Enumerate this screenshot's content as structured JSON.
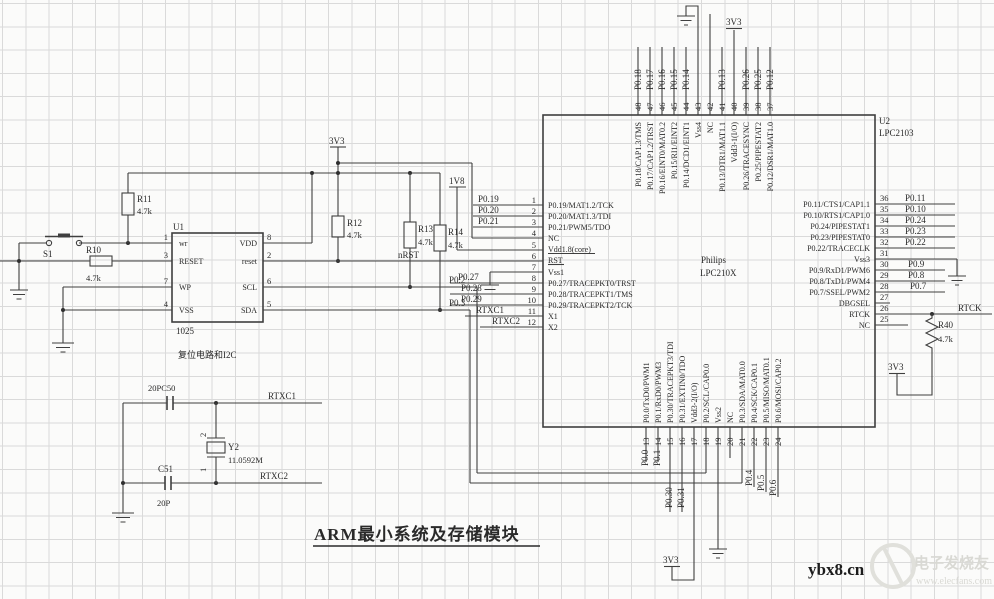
{
  "title": "ARM最小系统及存储模块",
  "watermark": {
    "site": "ybx8.cn",
    "brand": "电子发烧友",
    "url": "www.elecfans.com"
  },
  "power": {
    "v3": "3V3",
    "v18": "1V8"
  },
  "nets": {
    "nrst": "nRST",
    "p02": "P0.2",
    "p03": "P0.3",
    "rtxc1": "RTXC1",
    "rtxc2": "RTXC2",
    "rtck": "RTCK"
  },
  "u1": {
    "ref": "U1",
    "part": "1025",
    "caption": "复位电路和I2C",
    "left_pins": [
      {
        "num": "1",
        "name": "wr"
      },
      {
        "num": "3",
        "name": "RESET"
      },
      {
        "num": "7",
        "name": "WP"
      },
      {
        "num": "4",
        "name": "VSS"
      }
    ],
    "right_pins": [
      {
        "num": "8",
        "name": "VDD"
      },
      {
        "num": "2",
        "name": "reset"
      },
      {
        "num": "6",
        "name": "SCL"
      },
      {
        "num": "5",
        "name": "SDA"
      }
    ]
  },
  "u2": {
    "ref": "U2",
    "part": "LPC2103",
    "maker": "Philips",
    "family": "LPC210X",
    "top_pins": [
      {
        "num": "48",
        "net": "P0.18",
        "name": "P0.18/CAP1.3/TMS"
      },
      {
        "num": "47",
        "net": "P0.17",
        "name": "P0.17/CAP1.2/TRST"
      },
      {
        "num": "46",
        "net": "P0.16",
        "name": "P0.16/EINT0/MAT0.2"
      },
      {
        "num": "45",
        "net": "P0.15",
        "name": "P0.15/RI1/EINT2"
      },
      {
        "num": "44",
        "net": "P0.14",
        "name": "P0.14/DCD1/EINT1"
      },
      {
        "num": "43",
        "net": "",
        "name": "Vss4"
      },
      {
        "num": "42",
        "net": "",
        "name": "NC"
      },
      {
        "num": "41",
        "net": "P0.13",
        "name": "P0.13/DTR1/MAT1.1"
      },
      {
        "num": "40",
        "net": "",
        "name": "Vdd3-1(I/O)"
      },
      {
        "num": "39",
        "net": "P0.26",
        "name": "P0.26/TRACESYNC"
      },
      {
        "num": "38",
        "net": "P0.25",
        "name": "P0.25/PIPESTAT2"
      },
      {
        "num": "37",
        "net": "P0.12",
        "name": "P0.12/DSR1/MAT1.0"
      }
    ],
    "left_pins": [
      {
        "num": "1",
        "net": "P0.19",
        "name": "P0.19/MAT1.2/TCK"
      },
      {
        "num": "2",
        "net": "P0.20",
        "name": "P0.20/MAT1.3/TDI"
      },
      {
        "num": "3",
        "net": "P0.21",
        "name": "P0.21/PWM5/TDO"
      },
      {
        "num": "4",
        "net": "",
        "name": "NC"
      },
      {
        "num": "5",
        "net": "",
        "name": "Vdd1.8(core)"
      },
      {
        "num": "6",
        "net": "",
        "name": "RST"
      },
      {
        "num": "7",
        "net": "",
        "name": "Vss1"
      },
      {
        "num": "8",
        "net": "P0.27",
        "name": "P0.27/TRACEPKT0/TRST"
      },
      {
        "num": "9",
        "net": "P0.28",
        "name": "P0.28/TRACEPKT1/TMS"
      },
      {
        "num": "10",
        "net": "P0.29",
        "name": "P0.29/TRACEPKT2/TCK"
      },
      {
        "num": "11",
        "net": "RTXC1",
        "name": "X1"
      },
      {
        "num": "12",
        "net": "RTXC2",
        "name": "X2"
      }
    ],
    "right_pins": [
      {
        "num": "36",
        "net": "P0.11",
        "name": "P0.11/CTS1/CAP1.1"
      },
      {
        "num": "35",
        "net": "P0.10",
        "name": "P0.10/RTS1/CAP1.0"
      },
      {
        "num": "34",
        "net": "P0.24",
        "name": "P0.24/PIPESTAT1"
      },
      {
        "num": "33",
        "net": "P0.23",
        "name": "P0.23/PIPESTAT0"
      },
      {
        "num": "32",
        "net": "P0.22",
        "name": "P0.22/TRACECLK"
      },
      {
        "num": "31",
        "net": "",
        "name": "Vss3"
      },
      {
        "num": "30",
        "net": "P0.9",
        "name": "P0.9/RxD1/PWM6"
      },
      {
        "num": "29",
        "net": "P0.8",
        "name": "P0.8/TxD1/PWM4"
      },
      {
        "num": "28",
        "net": "P0.7",
        "name": "P0.7/SSEL/PWM2"
      },
      {
        "num": "27",
        "net": "",
        "name": "DBGSEL"
      },
      {
        "num": "26",
        "net": "RTCK",
        "name": "RTCK"
      },
      {
        "num": "25",
        "net": "",
        "name": "NC"
      }
    ],
    "bottom_pins": [
      {
        "num": "13",
        "net": "P0.0",
        "name": "P0.0/TxD0/PWM1"
      },
      {
        "num": "14",
        "net": "P0.1",
        "name": "P0.1/RxD0/PWM3"
      },
      {
        "num": "15",
        "net": "P0.30",
        "name": "P0.30/TRACEPKT3/TDI"
      },
      {
        "num": "16",
        "net": "P0.31",
        "name": "P0.31/EXTIN0/TDO"
      },
      {
        "num": "17",
        "net": "",
        "name": "Vdd3-2(I/O)"
      },
      {
        "num": "18",
        "net": "",
        "name": "P0.2/SCL/CAP0.0"
      },
      {
        "num": "19",
        "net": "",
        "name": "Vss2"
      },
      {
        "num": "20",
        "net": "",
        "name": "NC"
      },
      {
        "num": "21",
        "net": "",
        "name": "P0.3/SDA/MAT0.0"
      },
      {
        "num": "22",
        "net": "P0.4",
        "name": "P0.4/SCK/CAP0.1"
      },
      {
        "num": "23",
        "net": "P0.5",
        "name": "P0.5/MISO/MAT0.1"
      },
      {
        "num": "24",
        "net": "P0.6",
        "name": "P0.6/MOSI/CAP0.2"
      }
    ]
  },
  "resistors": {
    "r10": {
      "ref": "R10",
      "value": "4.7k"
    },
    "r11": {
      "ref": "R11",
      "value": "4.7k"
    },
    "r12": {
      "ref": "R12",
      "value": "4.7k"
    },
    "r13": {
      "ref": "R13",
      "value": "4.7k"
    },
    "r14": {
      "ref": "R14",
      "value": "4.7k"
    },
    "r40": {
      "ref": "R40",
      "value": "4.7k"
    }
  },
  "caps": {
    "c50_label": "20PC50",
    "c51_ref": "C51",
    "c51_value": "20P"
  },
  "crystal": {
    "ref": "Y2",
    "value": "11.0592M",
    "pin_top": "2",
    "pin_bottom": "1"
  },
  "switch": {
    "ref": "S1"
  }
}
